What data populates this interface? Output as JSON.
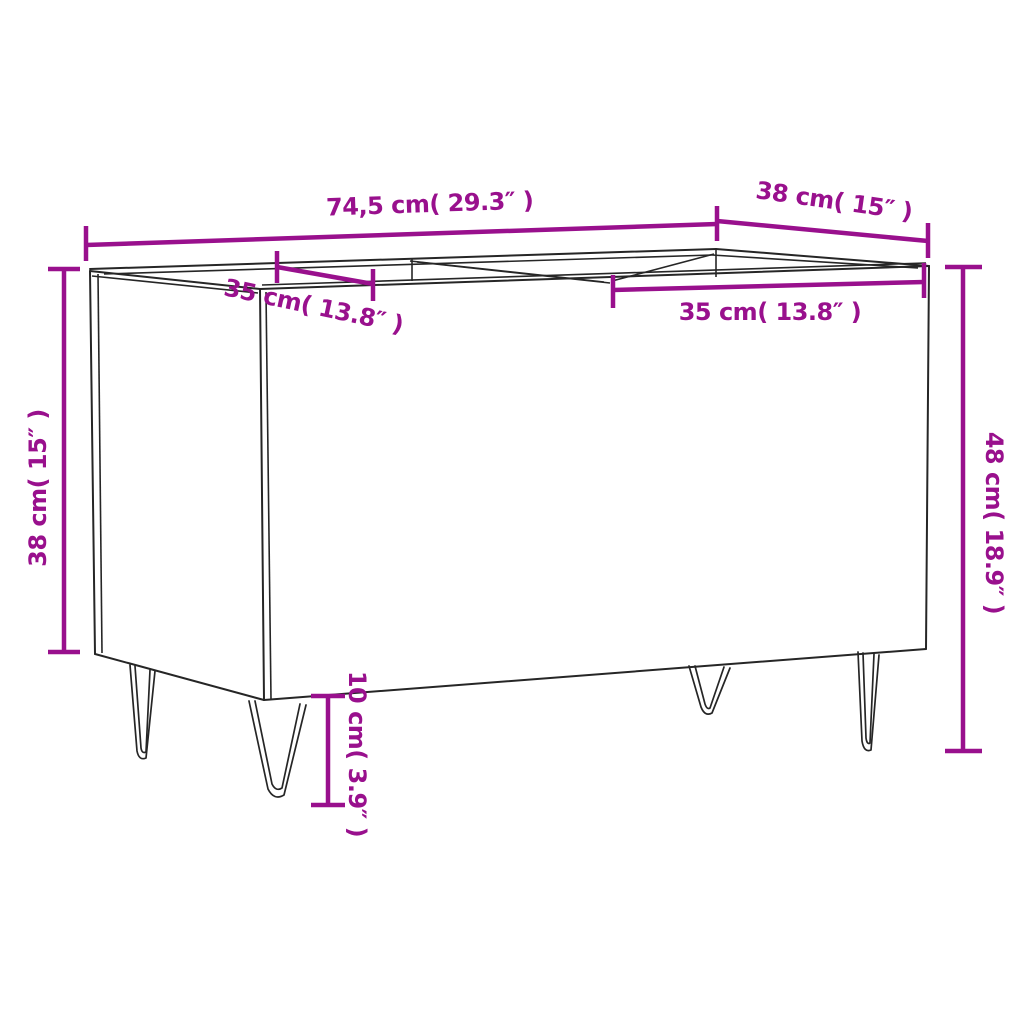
{
  "colors": {
    "accent": "#99108d",
    "line": "#262626",
    "background": "#ffffff"
  },
  "diagram": {
    "subject": "record-cabinet-with-hairpin-legs",
    "view": "three-quarter perspective line drawing with dimension callouts",
    "dimensions": {
      "width_top": {
        "label": "74,5 cm( 29.3″ )",
        "cm": "74,5",
        "inch": "29.3",
        "measures": "overall width along top back edge"
      },
      "depth_top": {
        "label": "38 cm( 15″ )",
        "cm": "38",
        "inch": "15",
        "measures": "overall depth along top right edge"
      },
      "compartment_left": {
        "label": "35 cm( 13.8″ )",
        "cm": "35",
        "inch": "13.8",
        "measures": "left compartment opening"
      },
      "compartment_right": {
        "label": "35 cm( 13.8″ )",
        "cm": "35",
        "inch": "13.8",
        "measures": "right compartment opening"
      },
      "height_left": {
        "label": "38 cm( 15″ )",
        "cm": "38",
        "inch": "15",
        "measures": "cabinet body height"
      },
      "height_right": {
        "label": "48 cm( 18.9″ )",
        "cm": "48",
        "inch": "18.9",
        "measures": "total height including legs"
      },
      "leg_height": {
        "label": "10 cm( 3.9″ )",
        "cm": "10",
        "inch": "3.9",
        "measures": "leg height"
      }
    }
  }
}
